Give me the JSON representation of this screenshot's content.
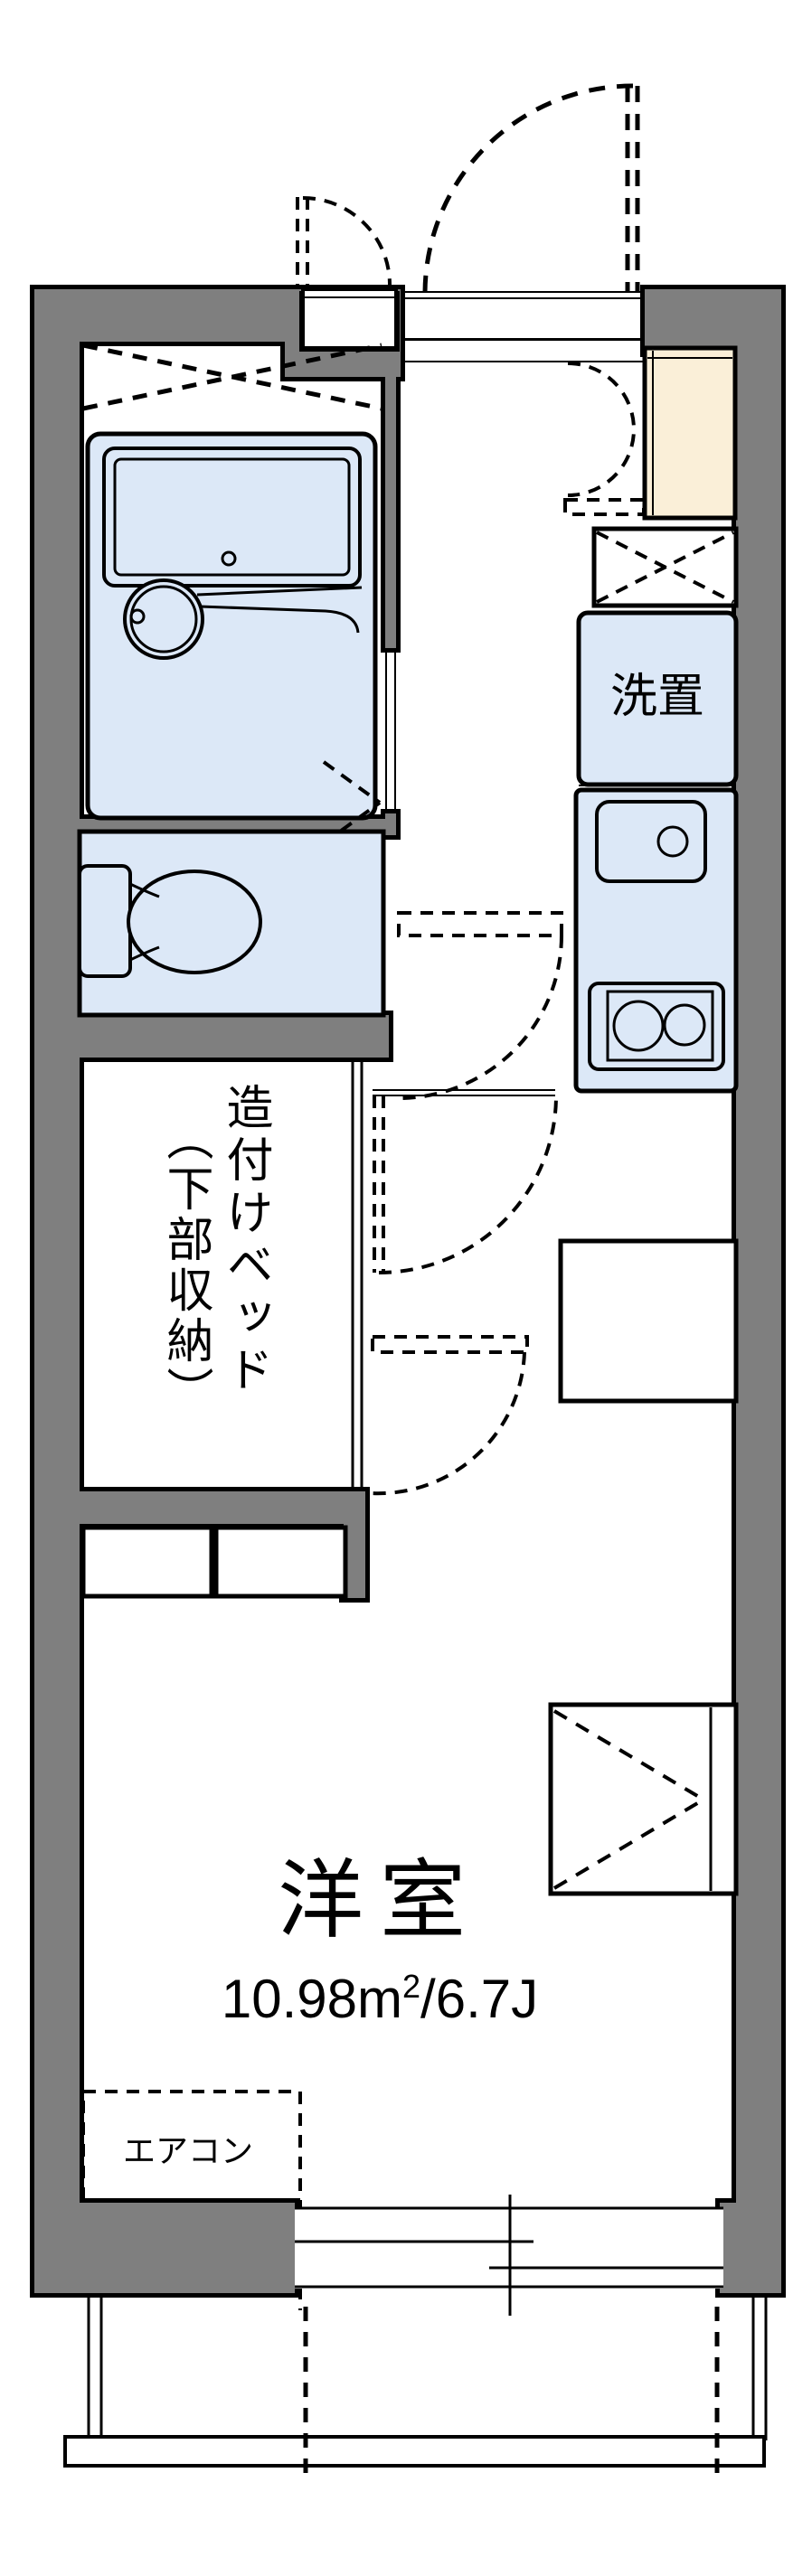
{
  "title": "apartment-floor-plan",
  "colors": {
    "wall": "#7f7f7f",
    "outline": "#000000",
    "fixture_fill": "#dce8f7",
    "genkan_fill": "#faefd8",
    "floor": "#ffffff"
  },
  "labels": {
    "washer": "洗置",
    "bed_main": "造付けベッド",
    "bed_sub": "（下部収納）",
    "room_name": "洋室",
    "area_value": "10.98",
    "area_unit_base": "m",
    "area_unit_sup": "2",
    "area_suffix": "/6.7J",
    "aircon": "エアコン"
  },
  "rooms": [
    {
      "name": "bathroom",
      "features": [
        "unit-bath",
        "bathtub",
        "round-basin"
      ]
    },
    {
      "name": "toilet",
      "features": [
        "toilet-bowl",
        "tank"
      ]
    },
    {
      "name": "washer-space",
      "label": "洗置"
    },
    {
      "name": "kitchen",
      "features": [
        "sink",
        "two-burner-stove",
        "refrigerator-space"
      ]
    },
    {
      "name": "built-in-bed",
      "label": "造付けベッド（下部収納）",
      "features": [
        "steps"
      ]
    },
    {
      "name": "western-room",
      "label": "洋室",
      "area": "10.98㎡/6.7J",
      "features": [
        "closet",
        "air-conditioner",
        "window"
      ]
    },
    {
      "name": "entrance",
      "features": [
        "entry-door",
        "meter-box",
        "genkan-step"
      ]
    },
    {
      "name": "balcony",
      "features": [
        "railing",
        "partition-dashes"
      ]
    }
  ]
}
